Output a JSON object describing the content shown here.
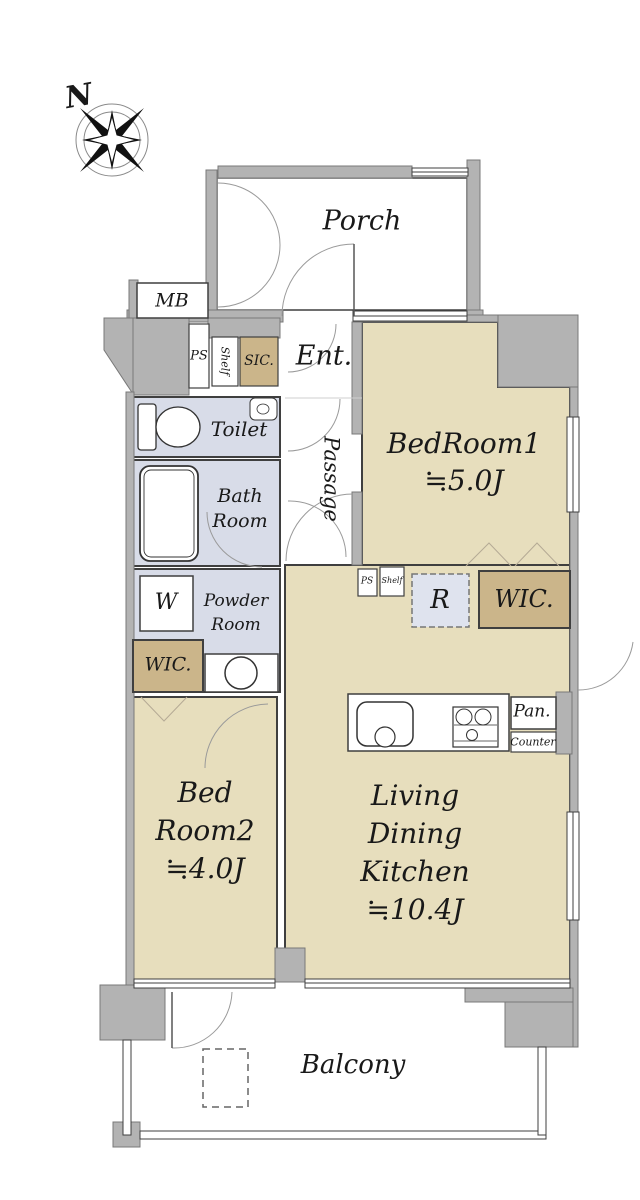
{
  "compass": {
    "label": "N"
  },
  "rooms": {
    "porch": {
      "label": "Porch"
    },
    "mb": {
      "label": "MB"
    },
    "ps_top": {
      "label": "PS"
    },
    "shelf_top": {
      "label": "Shelf"
    },
    "sic": {
      "label": "SIC."
    },
    "ent": {
      "label": "Ent."
    },
    "passage": {
      "label": "Passage"
    },
    "toilet": {
      "label": "Toilet"
    },
    "bedroom1": {
      "name": "BedRoom1",
      "area": "≒5.0J"
    },
    "bathroom": {
      "line1": "Bath",
      "line2": "Room"
    },
    "washer": {
      "label": "W"
    },
    "powder": {
      "line1": "Powder",
      "line2": "Room"
    },
    "wic_left": {
      "label": "WIC."
    },
    "ps_mid": {
      "label": "PS"
    },
    "shelf_mid": {
      "label": "Shelf"
    },
    "fridge": {
      "label": "R"
    },
    "wic_right": {
      "label": "WIC."
    },
    "pantry": {
      "label": "Pan."
    },
    "counter": {
      "label": "Counter"
    },
    "bedroom2": {
      "line1": "Bed",
      "line2": "Room2",
      "area": "≒4.0J"
    },
    "ldk": {
      "line1": "Living",
      "line2": "Dining",
      "line3": "Kitchen",
      "area": "≒10.4J"
    },
    "balcony": {
      "label": "Balcony"
    }
  },
  "colors": {
    "room_fill": "#e7debd",
    "closet_fill": "#cbb58a",
    "wet_area_fill": "#d8dce8",
    "fridge_fill": "#dfe3ee",
    "wall_fill": "#b3b3b3",
    "outline": "#3f3f3f"
  }
}
